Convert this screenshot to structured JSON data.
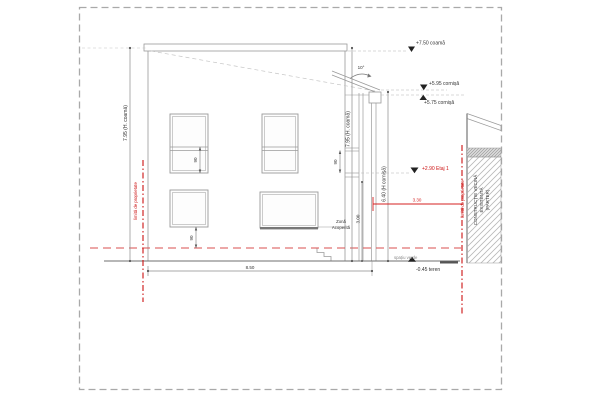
{
  "drawing": {
    "levels": {
      "coama": "+7.50 coamă",
      "cornisa_high": "+5.95 cornișă",
      "cornisa_low": "+5.75 cornișă",
      "etaj1": "+2.90 Etaj 1",
      "teren": "-0.45 teren"
    },
    "dimensions": {
      "height_left": "7.95 (H. coamă)",
      "height_right": "7.95 (H. coamă)",
      "height_cornisa": "6.40 (H cornișă)",
      "width_ground": "8.50",
      "setback": "3.30",
      "parter_height": "3.00",
      "window_1": "90",
      "window_2": "90",
      "window_3": "90",
      "roof_slope": "10°"
    },
    "labels": {
      "property_left": "limită de proprietate",
      "property_right": "limită de proprietate",
      "zona_1": "Zonă",
      "zona_2": "Acoperită",
      "spatiu_verde": "spațiu verde",
      "neighbor_1": "CONSTRUCȚIE VECINĂ",
      "neighbor_2": "EXISTENTĂ",
      "neighbor_3": "(PARTER)"
    },
    "colors": {
      "property_line": "#cc1111",
      "level_accent": "#cc1111",
      "drawing_line": "#9a9a9a",
      "ground_line": "#6f6f6f"
    }
  }
}
